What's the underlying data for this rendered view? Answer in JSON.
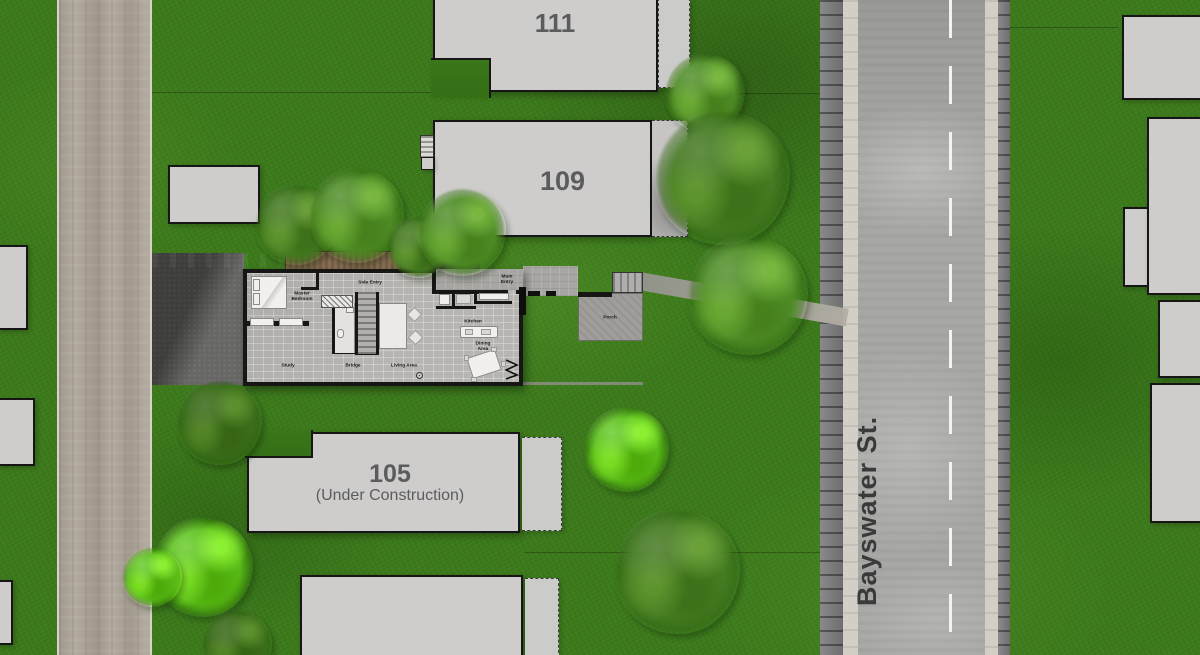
{
  "scene": {
    "type": "architectural site plan, overhead view"
  },
  "street": {
    "label": "Bayswater St."
  },
  "buildings": {
    "b111": {
      "number": "111"
    },
    "b109": {
      "number": "109"
    },
    "b105": {
      "number": "105",
      "status": "(Under Construction)"
    }
  },
  "floorplan": {
    "labels": {
      "master_bedroom": "Master\nBedroom",
      "side_entry": "Side Entry",
      "main_entry": "Main\nEntry",
      "kitchen": "Kitchen",
      "dining_area": "Dining Area",
      "living_area": "Living Area",
      "study": "Study",
      "bridge": "Bridge",
      "porch": "Porch"
    }
  },
  "colors": {
    "grass": "#3c7a1b",
    "left_road": "#b2aa9e",
    "asphalt": "#a7a7a5",
    "curb": "#7d7d7f",
    "building_fill": "#cecdcb",
    "wall_black": "#161616",
    "tree_green": "#4f8d27",
    "deck_wood": "#8a6f52",
    "label_gray": "#5c5c5e"
  }
}
